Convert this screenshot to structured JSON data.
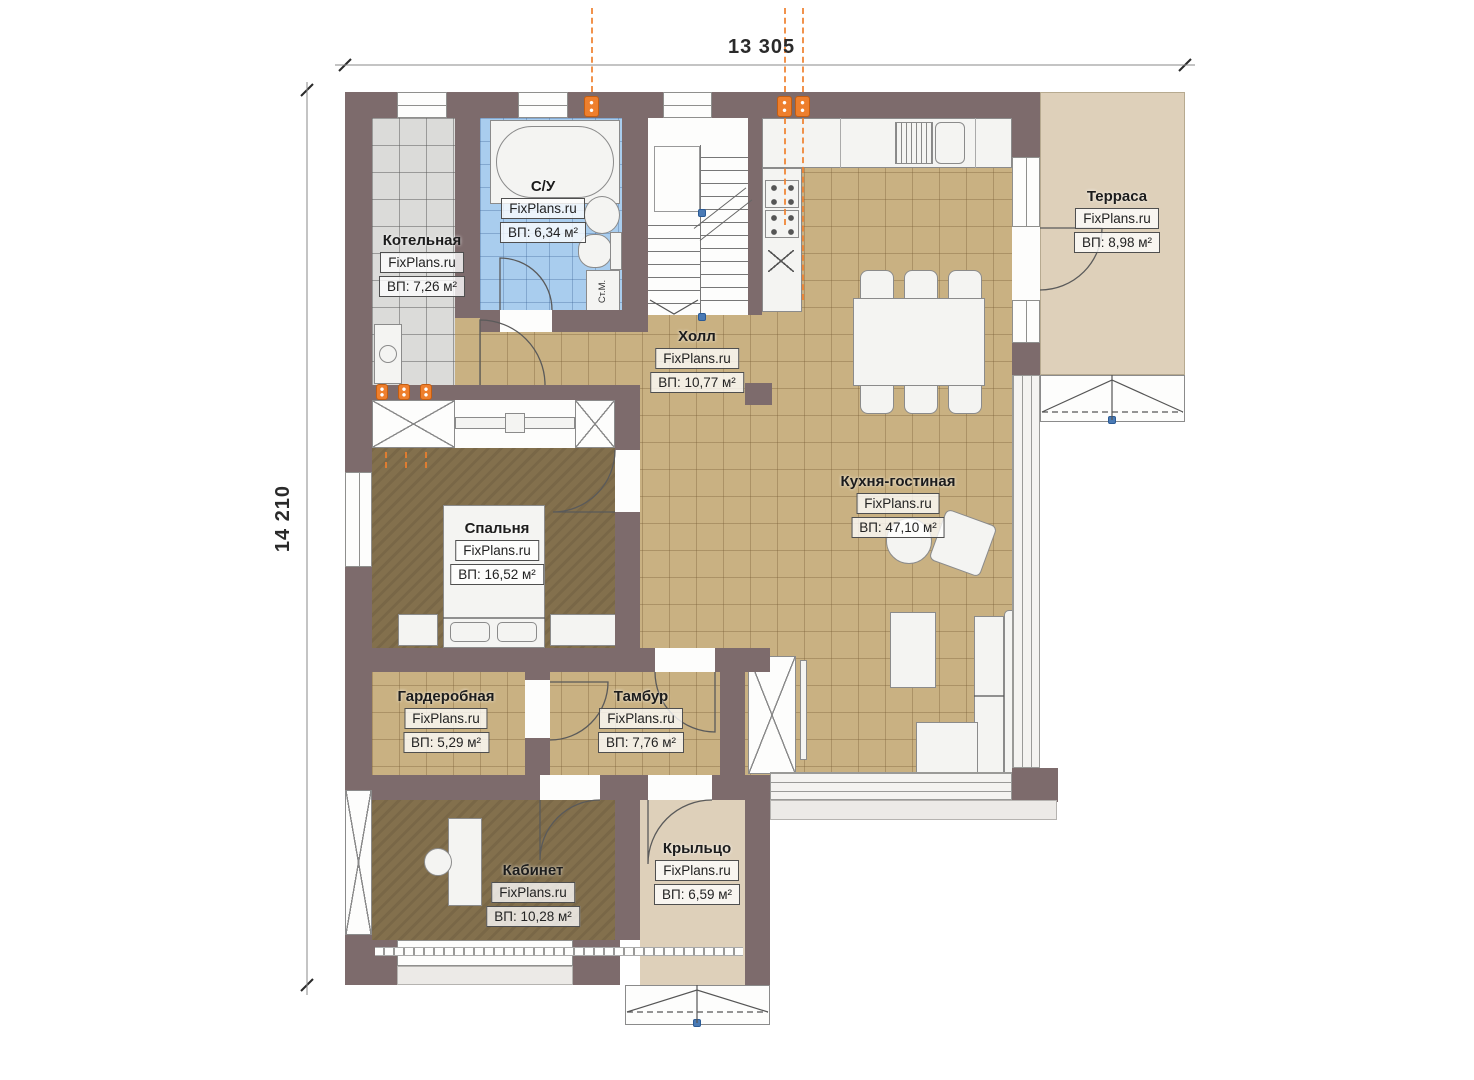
{
  "dimensions": {
    "top_width": "13 305",
    "left_height": "14 210"
  },
  "rooms": [
    {
      "key": "kotelnaya",
      "name": "Котельная",
      "brand": "FixPlans.ru",
      "area": "ВП: 7,26 м²"
    },
    {
      "key": "su",
      "name": "С/У",
      "brand": "FixPlans.ru",
      "area": "ВП: 6,34 м²"
    },
    {
      "key": "holl",
      "name": "Холл",
      "brand": "FixPlans.ru",
      "area": "ВП: 10,77 м²"
    },
    {
      "key": "terrasa",
      "name": "Терраса",
      "brand": "FixPlans.ru",
      "area": "ВП: 8,98 м²"
    },
    {
      "key": "kuhnya",
      "name": "Кухня-гостиная",
      "brand": "FixPlans.ru",
      "area": "ВП: 47,10 м²"
    },
    {
      "key": "spalnya",
      "name": "Спальня",
      "brand": "FixPlans.ru",
      "area": "ВП: 16,52 м²"
    },
    {
      "key": "garderobnaya",
      "name": "Гардеробная",
      "brand": "FixPlans.ru",
      "area": "ВП: 5,29 м²"
    },
    {
      "key": "tambur",
      "name": "Тамбур",
      "brand": "FixPlans.ru",
      "area": "ВП: 7,76 м²"
    },
    {
      "key": "kabinet",
      "name": "Кабинет",
      "brand": "FixPlans.ru",
      "area": "ВП: 10,28 м²"
    },
    {
      "key": "kryltso",
      "name": "Крыльцо",
      "brand": "FixPlans.ru",
      "area": "ВП: 6,59 м²"
    }
  ],
  "annotations": {
    "washing_machine": "Ст.М."
  },
  "colors": {
    "wall": "#7d6b6c",
    "tile_beige": "#c9b182",
    "tile_gray": "#dbdbd9",
    "tile_blue": "#a9cdee",
    "wood": "#83704d",
    "terrace": "#ded0ba",
    "accent_orange": "#ee7f2d",
    "marker_blue": "#4a7ab5",
    "line": "#5a5a5a"
  }
}
